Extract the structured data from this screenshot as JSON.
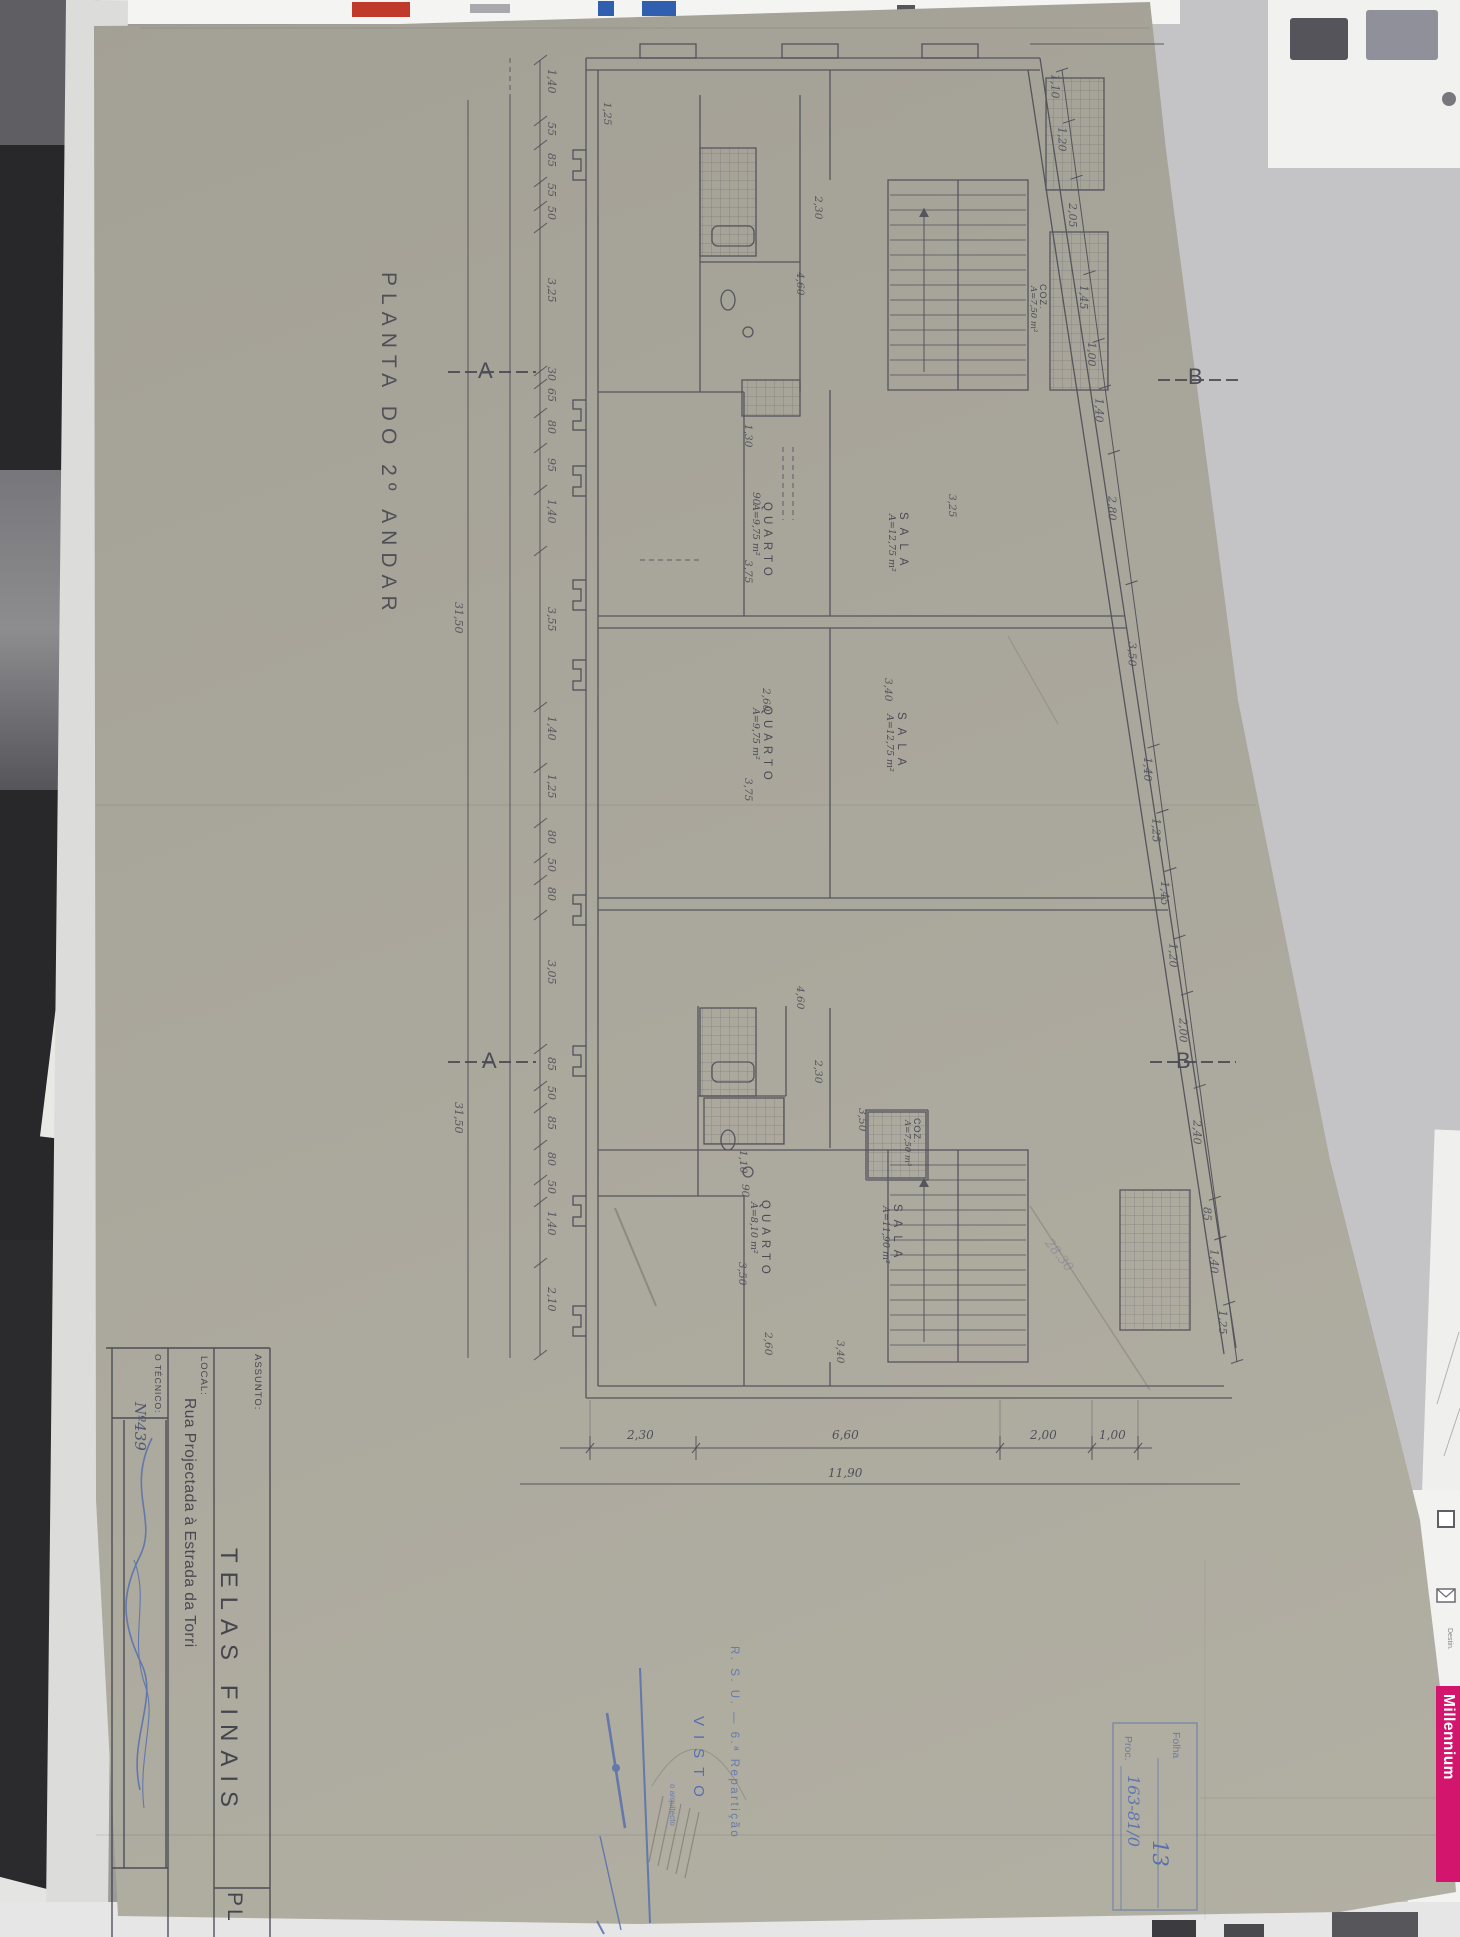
{
  "photo": {
    "millennium": "Millennium",
    "side_label": "Destin."
  },
  "titleblock": {
    "assunto_label": "ASSUNTO:",
    "assunto_value": "TELAS FINAIS",
    "local_label": "LOCAL:",
    "local_value": "Rua Projectada à Estrada da Torri",
    "tecnico_label": "O TÉCNICO:",
    "tecnico_number": "Nº439",
    "sheet_code": "PL"
  },
  "plan": {
    "title": "PLANTA DO 2º ANDAR",
    "section_a": "A",
    "section_b": "B",
    "rooms": [
      {
        "name": "QUARTO",
        "area": "A=9,75 m²"
      },
      {
        "name": "QUARTO",
        "area": "A=9,75 m²"
      },
      {
        "name": "SALA",
        "area": "A=12,75 m²"
      },
      {
        "name": "SALA",
        "area": "A=12,75 m²"
      },
      {
        "name": "QUARTO",
        "area": "A=8,10 m²"
      },
      {
        "name": "SALA",
        "area": "A=11,90 m²"
      },
      {
        "name": "COZ.",
        "area": "A=7,50 m²"
      },
      {
        "name": "COZ.",
        "area": "A=7,50 m²"
      }
    ],
    "dims": {
      "left_chain": [
        "1,40",
        "55",
        "85",
        "55",
        "50",
        "3,25",
        "30",
        "65",
        "80",
        "95",
        "1,40",
        "3,55",
        "1,40",
        "1,25",
        "80",
        "50",
        "80",
        "3,05",
        "85",
        "50",
        "85",
        "80",
        "50",
        "1,40",
        "2,10"
      ],
      "left_total": "31,50",
      "right_chain": [
        "1,10",
        "1,20",
        "2,05",
        "1,45",
        "1,00",
        "1,40",
        "2,80",
        "3,50",
        "1,40",
        "1,25",
        "1,45",
        "1,20",
        "2,00",
        "2,40",
        "85",
        "1,40",
        "1,25"
      ],
      "bottom_chain": [
        "2,30",
        "6,60",
        "2,00",
        "1,00"
      ],
      "bottom_total": "11,90",
      "interior": [
        "2,30",
        "4,60",
        "1,30",
        "90",
        "3,75",
        "2,60",
        "3,40",
        "3,25",
        "2,60",
        "3,75",
        "4,60",
        "2,30",
        "1,10",
        "90",
        "3,50",
        "3,40",
        "3,50",
        "1,25"
      ]
    }
  },
  "stamps": {
    "rsu_line": "R. S. U. — 6.ª Repartição",
    "visto": "VISTO",
    "arquitecto": "o arquitecto",
    "folha_label": "Folha",
    "folha_value": "13",
    "proc_label": "Proc.",
    "proc_value": "163-81/0",
    "note_diagonal": "28.30"
  }
}
